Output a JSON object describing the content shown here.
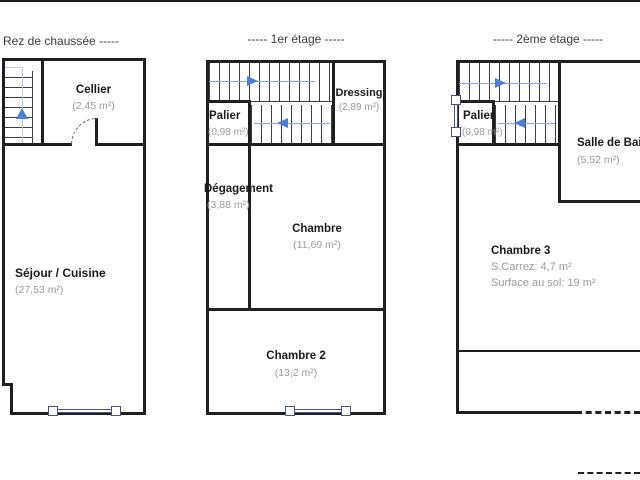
{
  "colors": {
    "bg": "#ffffff",
    "wall": "#1f1f1f",
    "tread": "#3d3d3d",
    "arrow_blue": "#4d7fd2",
    "line_blue": "#8aa5dc",
    "guide_blue": "#bcc9e9",
    "window_frame": "#4a5380",
    "label": "#1a1a1a",
    "area_text": "#9b9b9b",
    "title_text": "#3c3c3c"
  },
  "floors": [
    {
      "title": "Rez de chaussée  -----",
      "rooms": [
        {
          "name": "Cellier",
          "area": "(2,45 m²)"
        },
        {
          "name": "Séjour / Cuisine",
          "area": "(27,53 m²)"
        }
      ]
    },
    {
      "title": "-----  1er étage  -----",
      "rooms": [
        {
          "name": "Palier",
          "area": "(0,98 m²)"
        },
        {
          "name": "Dressing",
          "area": "(2,89 m²)"
        },
        {
          "name": "Dégagement",
          "area": "(3,88 m²)"
        },
        {
          "name": "Chambre",
          "area": "(11,69 m²)"
        },
        {
          "name": "Chambre 2",
          "area": "(13,2 m²)"
        }
      ]
    },
    {
      "title": "-----  2ème étage  -----",
      "rooms": [
        {
          "name": "Palier",
          "area": "(0,98 m²)"
        },
        {
          "name": "Salle de Bain",
          "area": "(5,52 m²)"
        },
        {
          "name": "Chambre 3",
          "area_lines": [
            "S.Carrez: 4,7 m²",
            "Surface au sol: 19 m²"
          ]
        }
      ]
    }
  ]
}
